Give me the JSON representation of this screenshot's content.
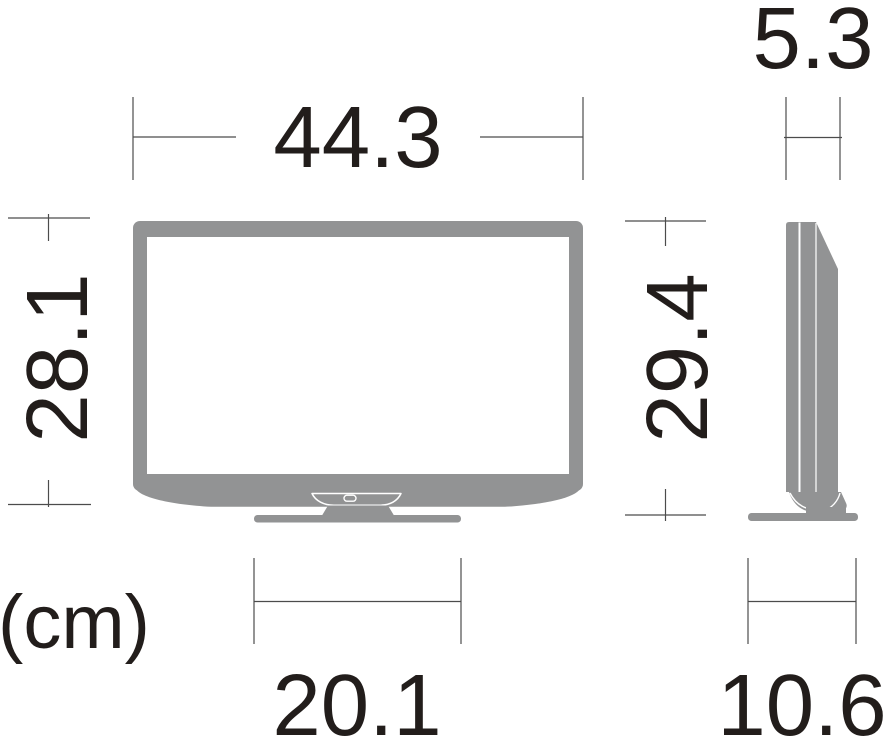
{
  "unit_label": "(cm)",
  "colors": {
    "body_gray": "#929394",
    "screen_white": "#ffffff",
    "dimension_line": "#4c4c4c",
    "text": "#221d1b"
  },
  "dimensions": {
    "front_width": "44.3",
    "front_height": "28.1",
    "total_height": "29.4",
    "front_stand_width": "20.1",
    "side_depth": "5.3",
    "side_stand_depth": "10.6"
  }
}
